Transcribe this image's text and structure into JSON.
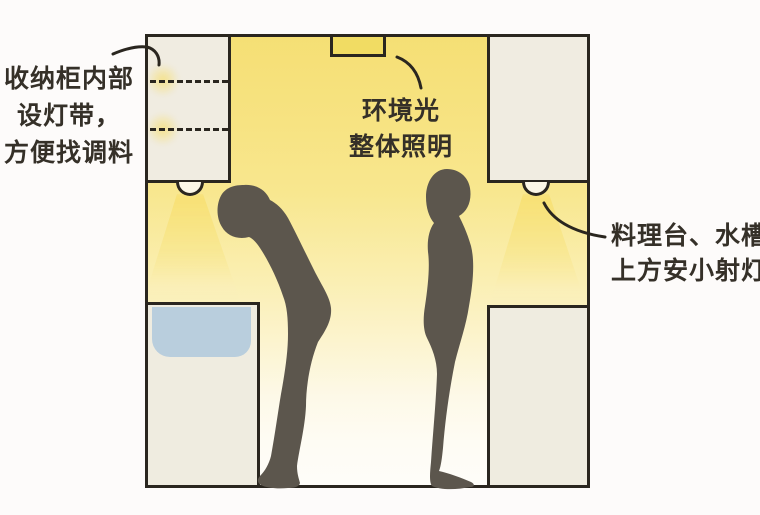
{
  "title": "kitchen-lighting-illustration",
  "annotations": {
    "cabinet_light": {
      "lines": [
        "收纳柜内部",
        "设灯带，",
        "方便找调料"
      ]
    },
    "ambient_light": {
      "lines": [
        "环境光",
        "整体照明"
      ]
    },
    "task_light": {
      "lines": [
        "料理台、水槽",
        "上方安小射灯"
      ]
    }
  },
  "elements": {
    "ceiling_lamp": "ceiling-flush-lamp",
    "left_upper_cabinet": "storage-cabinet-with-light-strips",
    "right_upper_cabinet": "wall-cabinet",
    "left_counter": "sink-counter",
    "right_counter": "worktop-counter",
    "downlights": "under-cabinet-spotlights",
    "left_person": "person-stooping-silhouette",
    "right_person": "person-upright-silhouette"
  },
  "colors": {
    "background": "#fdfbfa",
    "outline": "#2a261f",
    "ambient_yellow": "#f7e37d",
    "ceiling_lamp_yellow": "#f1dc63",
    "cabinet_cream": "#f0ece1",
    "sink_blue": "#b9cedd",
    "silhouette_gray": "#5c564d",
    "text": "#353028"
  }
}
